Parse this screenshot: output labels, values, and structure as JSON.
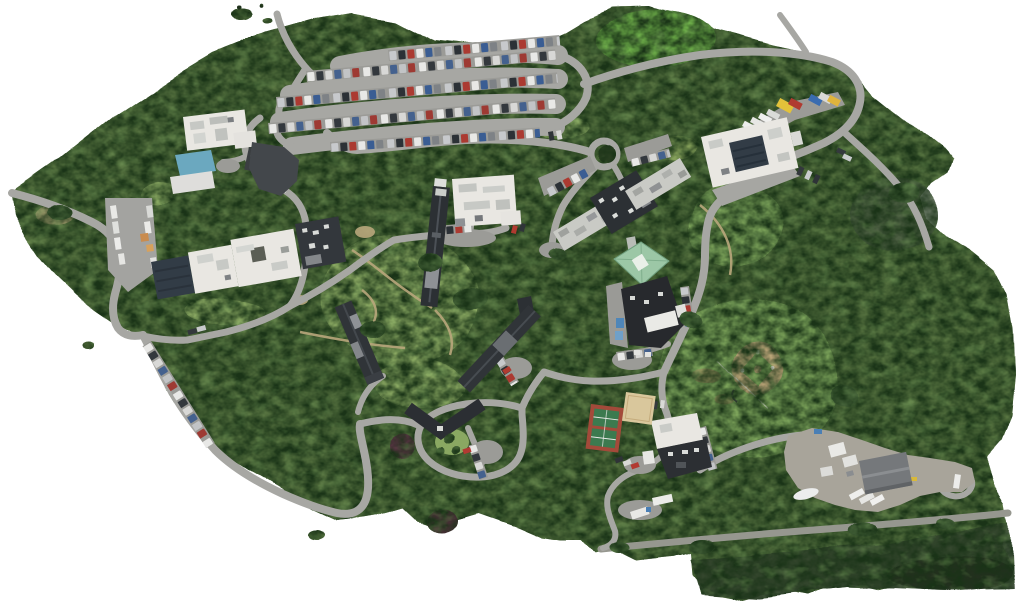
{
  "meta": {
    "title": "Drone orthomosaic aerial view of a wooded campus",
    "description": "Stitched aerial photo map: dense woodland with campus buildings, serpentine parking rows, loop roads, a baseball field, tennis and volleyball courts, and a maintenance yard. Irregular white edges where the orthomosaic has no data.",
    "background": "#ffffff"
  },
  "palette": {
    "forest": "#55713f",
    "forestDark": "#46633a",
    "lawn": "#7fa65c",
    "brightLawn": "#6fb04a",
    "quadLawn": "#8aa862",
    "grayTrees": "#4a5a44",
    "darkStrip": "#33432c",
    "water": "#222e1e",
    "road": "#a7a7a3",
    "roadDim": "#96978f",
    "pavement": "#9b9b97",
    "dirtPath": "#b9a77c",
    "roofWhite": "#e9e7e2",
    "roofDark": "#2c3034",
    "roofGray": "#c9cac5",
    "roofGreen": "#9cc7a6",
    "roofTeal": "#6ba8bf",
    "solar": "#323c46",
    "tennisRed": "#a34a3a",
    "tennisGreen": "#3c7a4f",
    "sand": "#d9c79c",
    "infield": "#c9ae80",
    "treeMaroon": "#583243"
  },
  "features": [
    {
      "id": "woodland",
      "label": "Dense woodland canopy"
    },
    {
      "id": "clearing",
      "label": "Bright grass clearing"
    },
    {
      "id": "serpentine-parking",
      "label": "Serpentine parking rows with cars"
    },
    {
      "id": "northeast-loop",
      "label": "Northeast loop road"
    },
    {
      "id": "service-trucks",
      "label": "Row of service trucks and containers"
    },
    {
      "id": "northeast-building",
      "label": "Northeast building with rooftop solar array"
    },
    {
      "id": "northwest-building",
      "label": "Northwest white-roof building"
    },
    {
      "id": "pool-pavilion",
      "label": "Teal-roof pavilion and deck"
    },
    {
      "id": "west-complex",
      "label": "West building complex with solar wing"
    },
    {
      "id": "central-long-hall",
      "label": "Long central dark-roof hall"
    },
    {
      "id": "central-white-hall",
      "label": "Central white-roof hall"
    },
    {
      "id": "east-complex",
      "label": "East hall complex with rooftop units"
    },
    {
      "id": "green-roof-hall",
      "label": "Green hip-roof hall"
    },
    {
      "id": "south-hall",
      "label": "Dark-roof hall with white tents"
    },
    {
      "id": "central-quad",
      "label": "Central quad lawn with footpaths"
    },
    {
      "id": "diagonal-dorm-a",
      "label": "Diagonal dark-roof dorm (east)"
    },
    {
      "id": "diagonal-dorm-b",
      "label": "Diagonal dark-roof dorm (west)"
    },
    {
      "id": "chevron-building",
      "label": "Chevron-shaped building"
    },
    {
      "id": "loop-drive",
      "label": "Oval loop drive with islands"
    },
    {
      "id": "roadside-parking",
      "label": "Southwest roadside parking"
    },
    {
      "id": "tennis-court",
      "label": "Tennis courts"
    },
    {
      "id": "volleyball-court",
      "label": "Sand volleyball court"
    },
    {
      "id": "baseball-field",
      "label": "Baseball field with dirt infield"
    },
    {
      "id": "fieldhouse",
      "label": "South building by ballfield"
    },
    {
      "id": "maintenance-yard",
      "label": "Maintenance yard with trailers and boat"
    },
    {
      "id": "perimeter-road",
      "label": "South perimeter road"
    },
    {
      "id": "truck-lot",
      "label": "West truck lot"
    },
    {
      "id": "circle-drive",
      "label": "Circle drive with tree island"
    }
  ]
}
